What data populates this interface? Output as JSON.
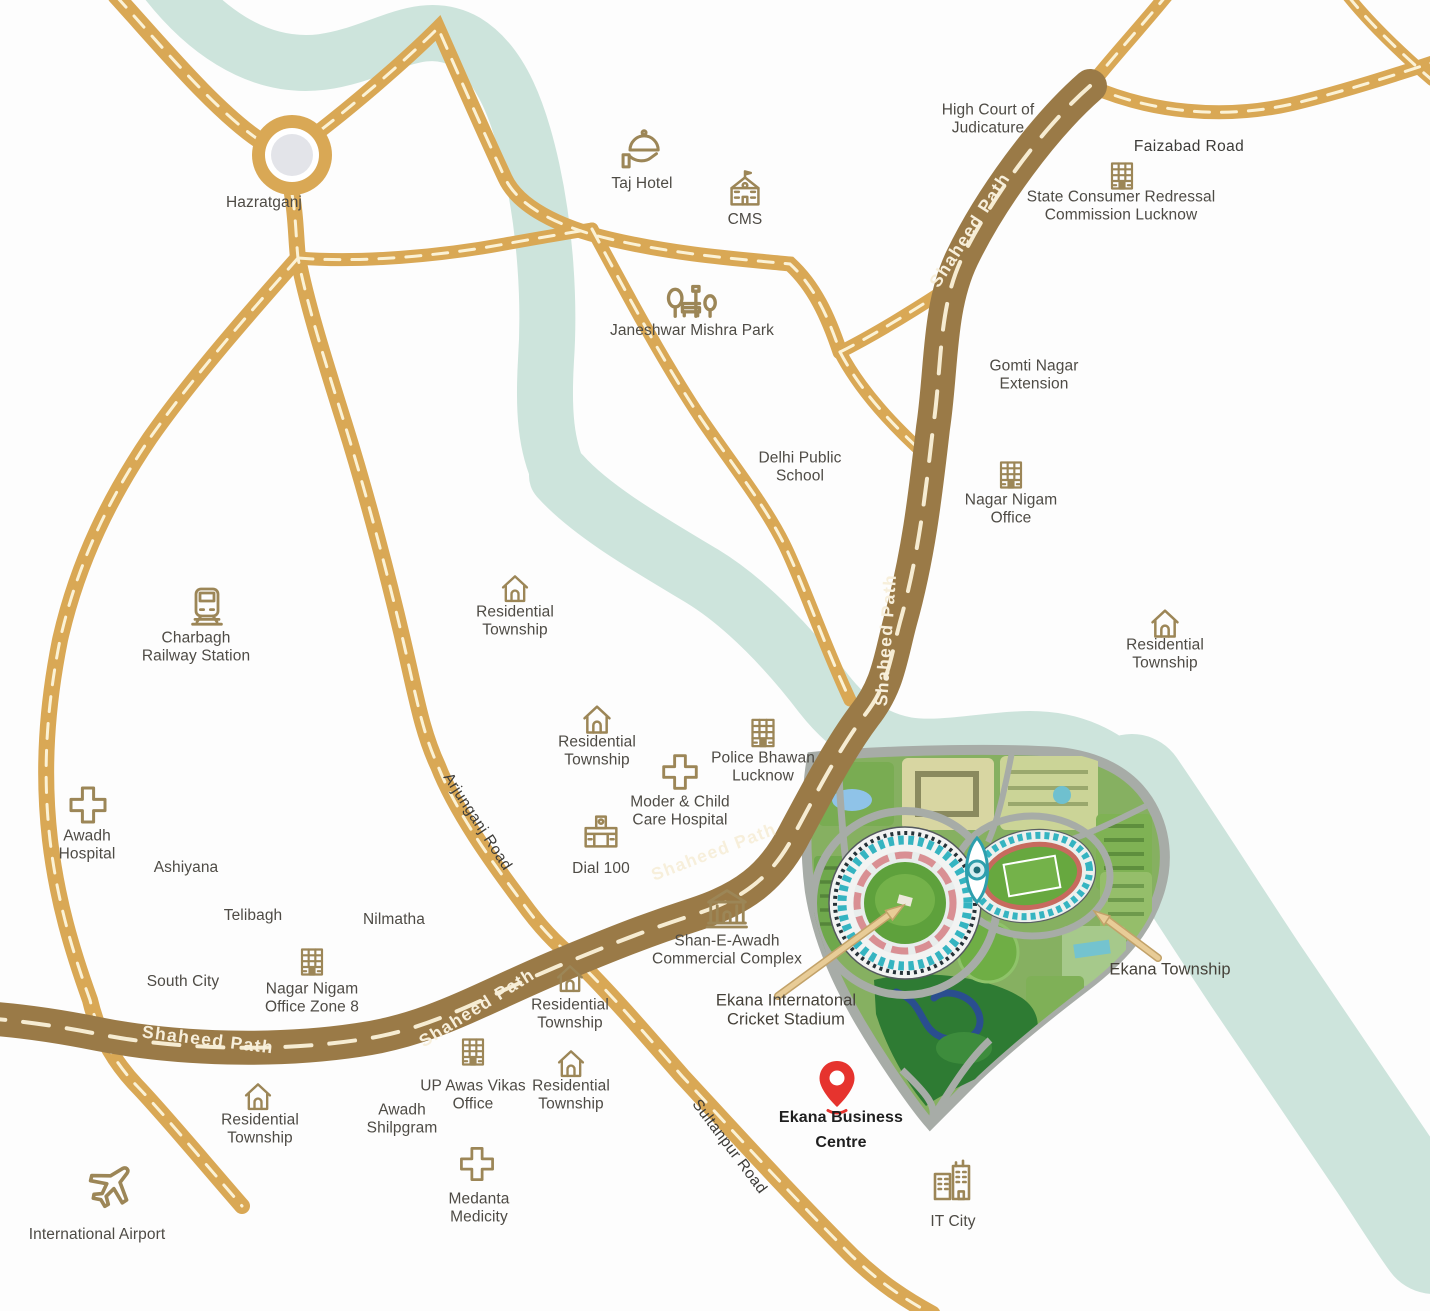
{
  "title": "Ekana Business Centre location map, Lucknow",
  "colors": {
    "background": "#ffffff",
    "road_minor": "#d9a855",
    "road_major": "#9a7a47",
    "road_dash": "#f8efd3",
    "river": "#cde4dc",
    "roundabout_inner": "#e3e4e9",
    "icon_stroke": "#9c8657",
    "label_text": "#4e4b45",
    "pin_red": "#e6332e",
    "arrow_tan": "#e8cc97"
  },
  "roads": {
    "shaheed_path_label": "Shaheed Path",
    "arjunganj_road_label": "Arjunganj Road",
    "sultanpur_road_label": "Sultanpur Road",
    "faizabad_road_label": "Faizabad Road"
  },
  "places": [
    {
      "id": "hazratganj",
      "label": "Hazratganj"
    },
    {
      "id": "taj-hotel",
      "label": "Taj Hotel",
      "icon": "cloche-icon"
    },
    {
      "id": "cms",
      "label": "CMS",
      "icon": "school-icon"
    },
    {
      "id": "high-court",
      "label": "High Court of\nJudicature"
    },
    {
      "id": "state-consumer-commission",
      "label": "State Consumer Redressal\nCommission Lucknow",
      "icon": "office-building-icon"
    },
    {
      "id": "janeshwar-mishra-park",
      "label": "Janeshwar Mishra Park",
      "icon": "park-icon"
    },
    {
      "id": "gomti-nagar-extension",
      "label": "Gomti Nagar\nExtension"
    },
    {
      "id": "delhi-public-school",
      "label": "Delhi Public\nSchool"
    },
    {
      "id": "nagar-nigam-office",
      "label": "Nagar Nigam\nOffice",
      "icon": "office-building-icon"
    },
    {
      "id": "residential-township-east",
      "label": "Residential\nTownship",
      "icon": "house-icon"
    },
    {
      "id": "residential-township-north",
      "label": "Residential\nTownship",
      "icon": "house-icon"
    },
    {
      "id": "charbagh-railway-station",
      "label": "Charbagh\nRailway Station",
      "icon": "train-icon"
    },
    {
      "id": "residential-township-mid",
      "label": "Residential\nTownship",
      "icon": "house-icon"
    },
    {
      "id": "police-bhawan",
      "label": "Police Bhawan\nLucknow",
      "icon": "office-building-icon"
    },
    {
      "id": "moder-child-hospital",
      "label": "Moder & Child\nCare Hospital",
      "icon": "cross-icon"
    },
    {
      "id": "dial-100",
      "label": "Dial 100",
      "icon": "station-building-icon"
    },
    {
      "id": "awadh-hospital",
      "label": "Awadh\nHospital",
      "icon": "cross-icon"
    },
    {
      "id": "ashiyana",
      "label": "Ashiyana"
    },
    {
      "id": "telibagh",
      "label": "Telibagh"
    },
    {
      "id": "nilmatha",
      "label": "Nilmatha"
    },
    {
      "id": "south-city",
      "label": "South City"
    },
    {
      "id": "nagar-nigam-zone8",
      "label": "Nagar Nigam\nOffice Zone 8",
      "icon": "office-building-icon"
    },
    {
      "id": "shan-e-awadh",
      "label": "Shan-E-Awadh\nCommercial Complex",
      "icon": "classical-building-icon"
    },
    {
      "id": "ekana-cricket-stadium",
      "label": "Ekana Internatonal\nCricket Stadium"
    },
    {
      "id": "ekana-township",
      "label": "Ekana Township"
    },
    {
      "id": "ekana-business-centre",
      "label": "Ekana Business\nCentre",
      "icon": "map-pin-icon"
    },
    {
      "id": "up-awas-vikas",
      "label": "UP Awas Vikas\nOffice",
      "icon": "office-building-icon"
    },
    {
      "id": "residential-township-a",
      "label": "Residential\nTownship",
      "icon": "house-icon"
    },
    {
      "id": "residential-township-b",
      "label": "Residential\nTownship",
      "icon": "house-icon"
    },
    {
      "id": "awadh-shilpgram",
      "label": "Awadh\nShilpgram"
    },
    {
      "id": "residential-township-sw",
      "label": "Residential\nTownship",
      "icon": "house-icon"
    },
    {
      "id": "medanta-medicity",
      "label": "Medanta\nMedicity",
      "icon": "cross-icon"
    },
    {
      "id": "international-airport",
      "label": "International Airport",
      "icon": "plane-icon"
    },
    {
      "id": "it-city",
      "label": "IT City",
      "icon": "city-buildings-icon"
    }
  ]
}
